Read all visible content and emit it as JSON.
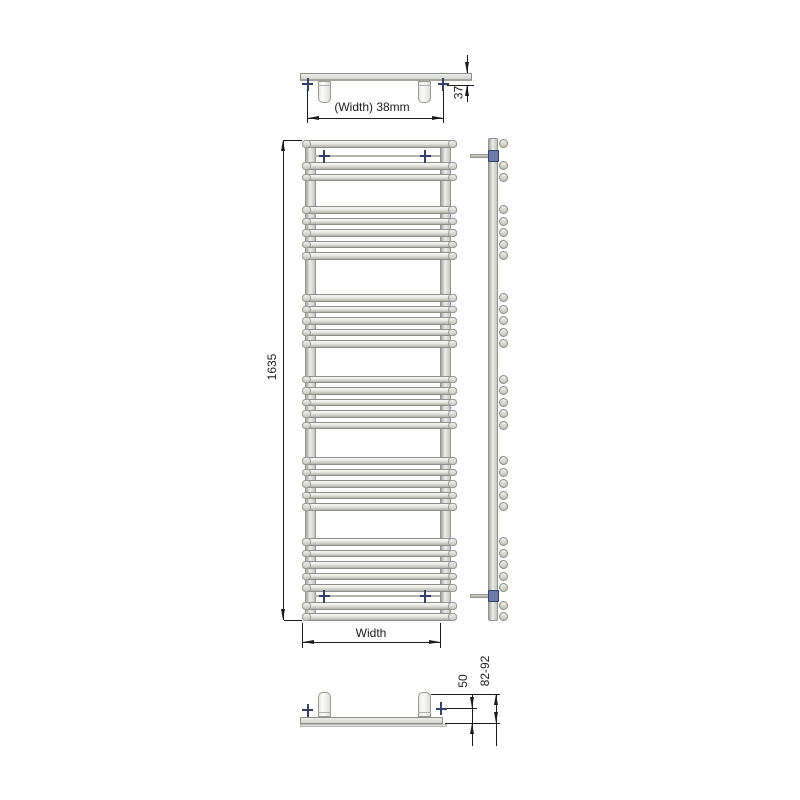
{
  "labels": {
    "top_width": "(Width) 38mm",
    "top_depth": "37",
    "overall_height": "1635",
    "bottom_width": "Width",
    "wall_to_rail": "50",
    "wall_to_front": "82-92"
  },
  "front_view": {
    "bar_x": 302,
    "bar_width": 155,
    "bar_height": 7.5,
    "bar_rows_y": [
      140,
      162,
      173.5,
      206,
      217.5,
      229,
      240.5,
      252,
      294,
      305.5,
      317,
      328.5,
      340,
      375.5,
      387,
      398.5,
      410,
      421.5,
      457,
      468.5,
      480,
      491.5,
      503,
      538,
      549.5,
      561,
      572.5,
      584,
      602,
      613
    ],
    "upright_xs": [
      304.5,
      439.5
    ],
    "upright_width": 11,
    "upright_top": 140,
    "upright_height": 480.5,
    "rail_rows_y": [
      156,
      596
    ],
    "cross_cols_x": [
      324,
      425
    ]
  },
  "side_view": {
    "rail_x": 488,
    "rail_width": 10,
    "rail_top": 138,
    "rail_height": 483,
    "knob_cx": 503,
    "knob_radius": 4.5,
    "bracket_rows_y": [
      156,
      596
    ]
  },
  "colors": {
    "line": "#1c1c1c",
    "text": "#1c1c1c",
    "cross": "#35406a",
    "nut": "#6b7aa6",
    "bar_border": "#8f8f89",
    "bar_fill": "#e3e3de"
  }
}
